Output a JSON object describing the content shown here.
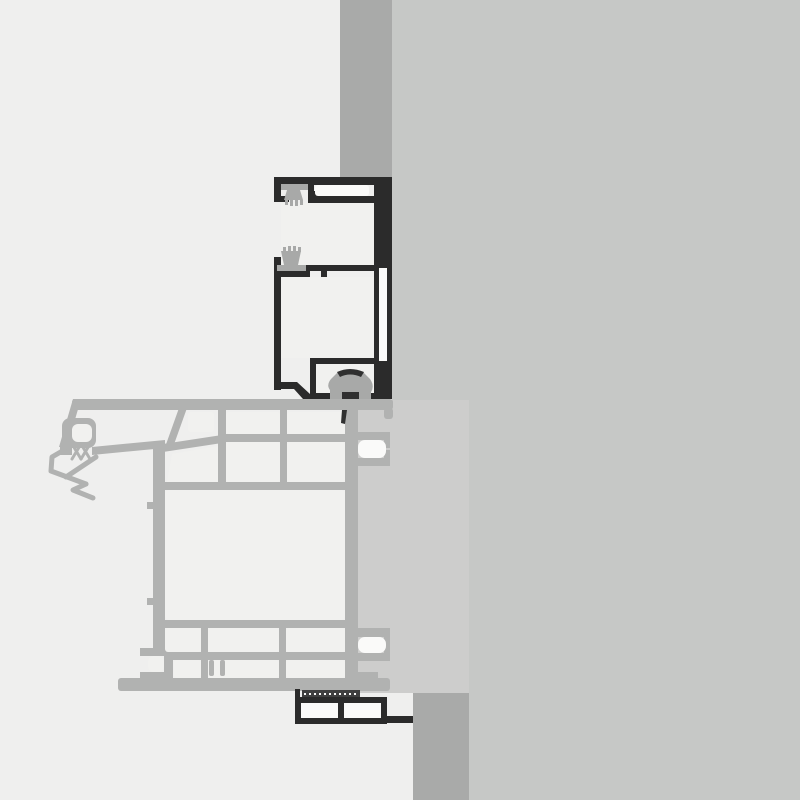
{
  "drawing": {
    "title": "aluminium-window-frame-cross-section",
    "canvas": {
      "width": 800,
      "height": 800
    }
  },
  "colors": {
    "bg_left": "#EFEFEE",
    "bg_right": "#C6C8C6",
    "wall": "#A9AAA9",
    "profile_dark": "#2B2B2B",
    "profile_gray": "#B1B2B1",
    "panel": "#CDCDCC",
    "chamber_white": "#F1F1EF",
    "slot_white": "#FAFAF9",
    "gasket_gray": "#A8A9A8",
    "gasket_dark": "#303030",
    "bead_dark": "#3F3F3F"
  },
  "components": {
    "wall_top": "masonry-section-above-frame",
    "wall_bottom": "masonry-section-below-sill",
    "frame": "fixed-frame-profile-dark",
    "sash": "sash-profile-gray",
    "panel": "glazing-panel",
    "brush_seal_top": "brush-seal",
    "brush_seal_middle": "brush-seal",
    "bulb_gasket": "bulb-gasket",
    "glazing_bead": "glazing-bead-profile",
    "gasket_strip": "gasket-strip"
  }
}
